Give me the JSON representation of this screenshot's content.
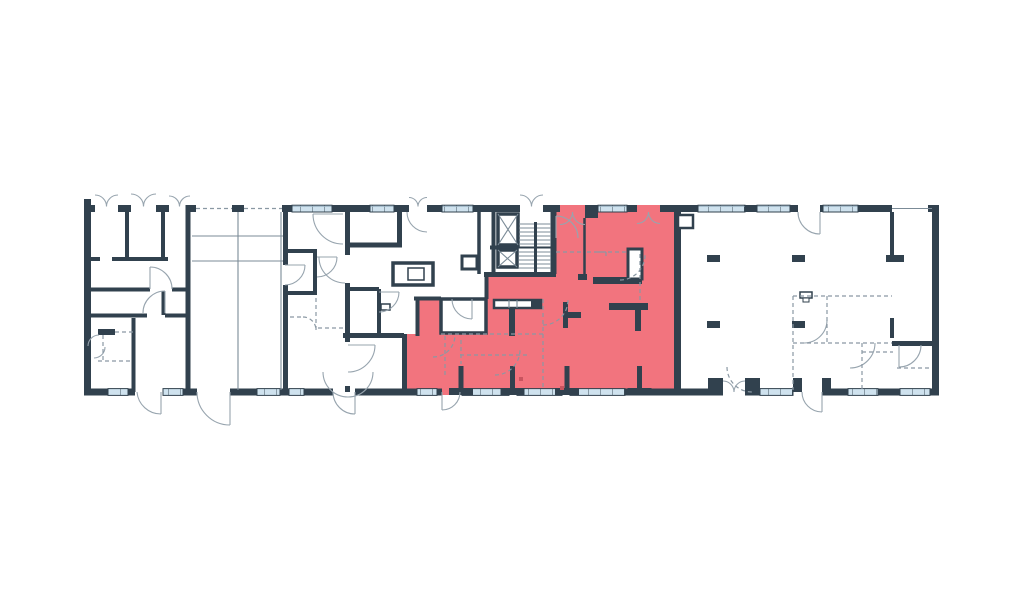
{
  "document": {
    "title": "Architectural floor plan with highlighted apartment unit",
    "background": "#ffffff"
  },
  "colors": {
    "walls": "#31414e",
    "highlighted_unit_fill": "#f2747e",
    "window_glass": "#cfe2ee",
    "thin_line": "#7b8b97",
    "dashed_line": "#8a98a3",
    "accent_dot": "#c9545f"
  },
  "highlighted_unit": {
    "name": "selected apartment",
    "fill": "#f2747e",
    "points": "551,205 681,205 681,395 402,395 402,334 418,334 418,299 486,299 486,276 551,276"
  },
  "plan": {
    "elevator_shafts": 2,
    "staircases": 1,
    "structural_columns": 4,
    "notes": "long linear building; window strips along top and bottom facades; dashed lines mark proposed partitions; quarter-circle arcs mark door swings"
  }
}
